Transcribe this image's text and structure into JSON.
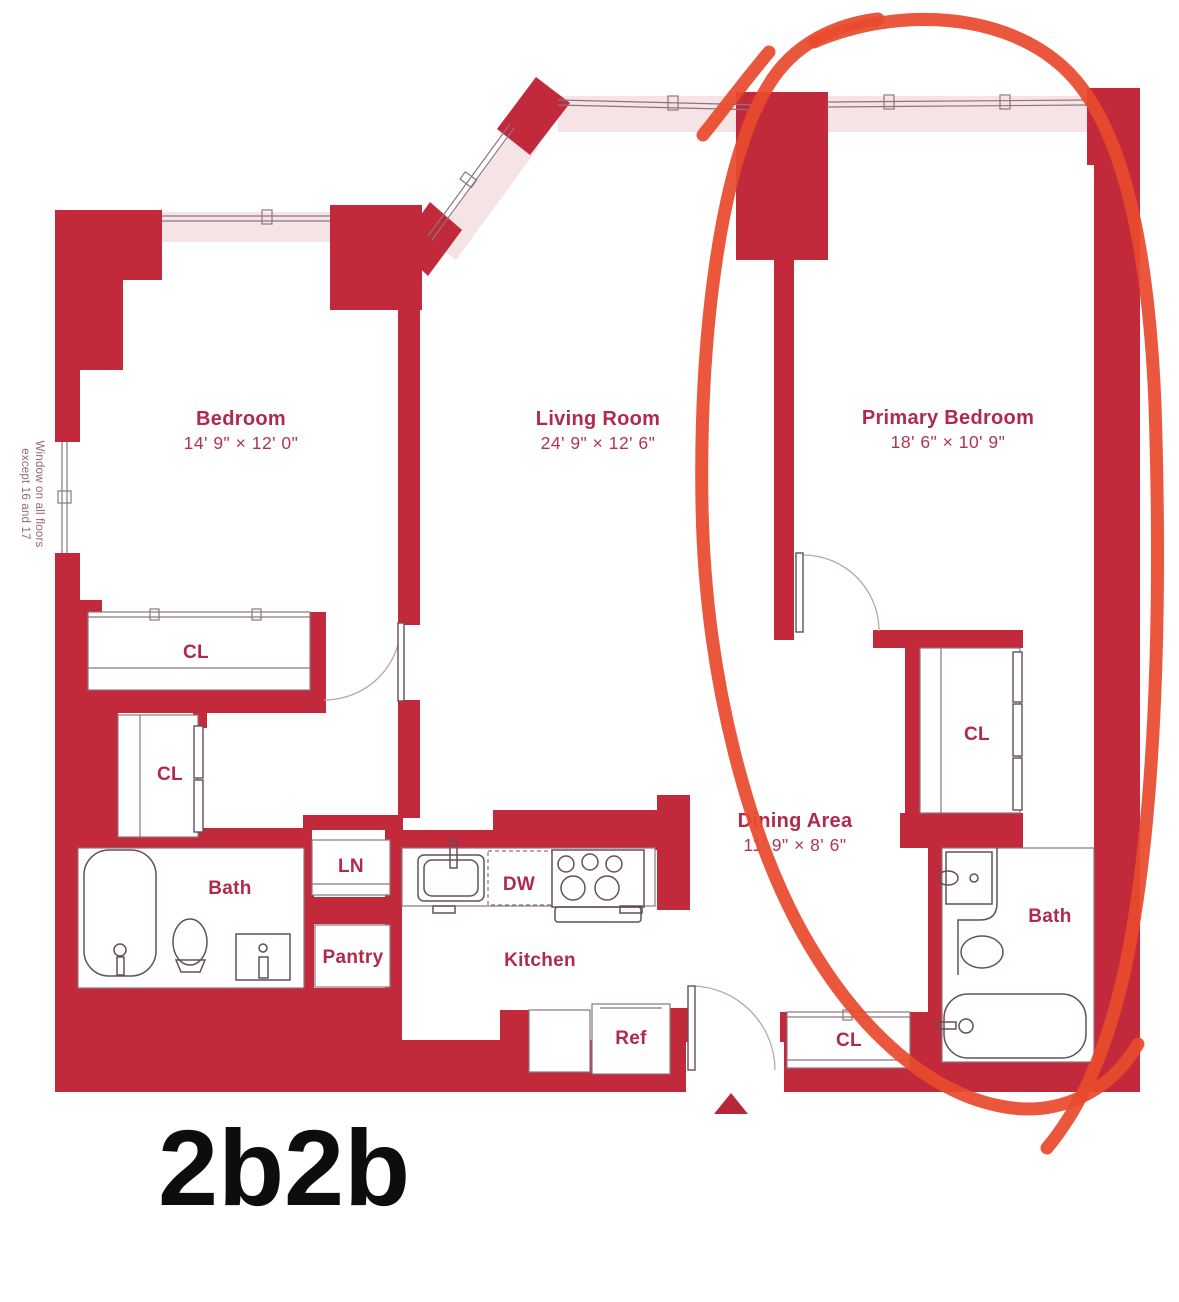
{
  "palette": {
    "wall": "#c2293a",
    "window_tint": "#f6e3e5",
    "outline": "#8b767c",
    "fixture_line": "#635058",
    "label": "#b02a4c",
    "annotation": "#e84a2d",
    "caption_color": "#0d0d0d"
  },
  "rooms": {
    "bedroom": {
      "name": "Bedroom",
      "dims": "14' 9\" × 12' 0\""
    },
    "living": {
      "name": "Living Room",
      "dims": "24' 9\" × 12' 6\""
    },
    "primary": {
      "name": "Primary Bedroom",
      "dims": "18' 6\" × 10' 9\""
    },
    "dining": {
      "name": "Dining Area",
      "dims": "11' 9\" × 8' 6\""
    },
    "kitchen": {
      "name": "Kitchen"
    },
    "bath_left": {
      "name": "Bath"
    },
    "bath_primary": {
      "name": "Bath"
    },
    "pantry": {
      "name": "Pantry"
    },
    "linen": {
      "name": "LN"
    },
    "dishwasher": {
      "name": "DW"
    },
    "refrigerator": {
      "name": "Ref"
    },
    "closet_bedroom": {
      "name": "CL"
    },
    "closet_hall": {
      "name": "CL"
    },
    "closet_primary": {
      "name": "CL"
    },
    "closet_entry": {
      "name": "CL"
    }
  },
  "note": {
    "line1": "Window on all floors",
    "line2": "except 16 and 17"
  },
  "caption": "2b2b",
  "annotation": {
    "shape": "hand-drawn-circle",
    "highlights": "Primary Bedroom wing"
  }
}
